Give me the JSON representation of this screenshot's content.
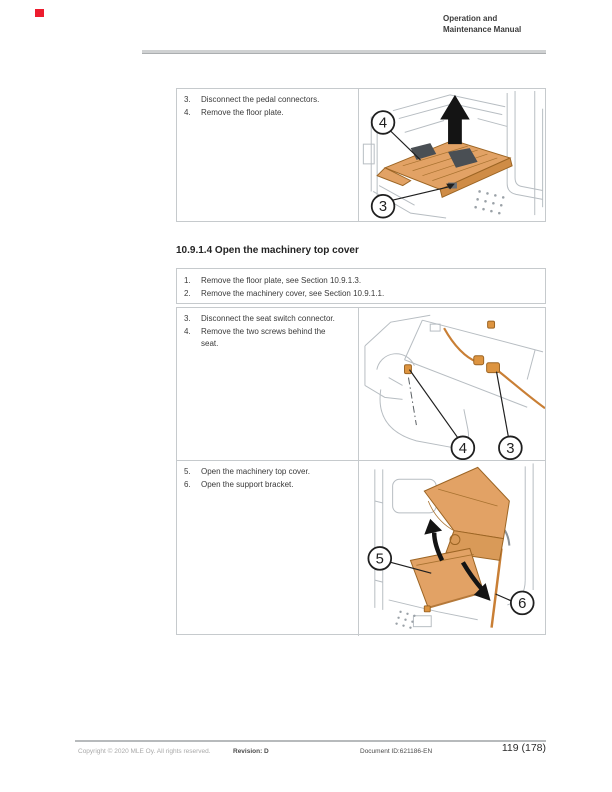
{
  "header": {
    "title_line1": "Operation and",
    "title_line2": "Maintenance Manual"
  },
  "section_heading": "10.9.1.4 Open the machinery top cover",
  "steps_pedal": [
    {
      "num": "3.",
      "text": "Disconnect the pedal connectors."
    },
    {
      "num": "4.",
      "text": "Remove the floor plate."
    }
  ],
  "steps_intro": [
    {
      "num": "1.",
      "text": "Remove the floor plate, see Section 10.9.1.3."
    },
    {
      "num": "2.",
      "text": "Remove the machinery cover, see Section 10.9.1.1."
    }
  ],
  "steps_seat": [
    {
      "num": "3.",
      "text": "Disconnect the seat switch connector."
    },
    {
      "num": "4.",
      "text": "Remove the two screws behind the seat."
    }
  ],
  "steps_cover": [
    {
      "num": "5.",
      "text": "Open the machinery top cover."
    },
    {
      "num": "6.",
      "text": "Open the support bracket."
    }
  ],
  "figures": {
    "floor_plate": {
      "callout_top": "4",
      "callout_bottom": "3"
    },
    "seat_switch": {
      "callout_left": "4",
      "callout_right": "3"
    },
    "top_cover": {
      "callout_left": "5",
      "callout_right": "6"
    }
  },
  "footer": {
    "copyright": "Copyright © 2020 MLE Oy. All rights reserved.",
    "revision": "Revision: D",
    "document_id": "Document ID:621186-EN",
    "page_number": "119 (178)"
  },
  "colors": {
    "highlight_orange": "#e2a265",
    "orange_outline": "#9c6524",
    "cable_orange": "#c97f35",
    "art_light_gray": "#b7bdc2",
    "art_medium_gray": "#8a9197",
    "table_border": "#c6cacd",
    "marker_red": "#ed1c2e"
  }
}
